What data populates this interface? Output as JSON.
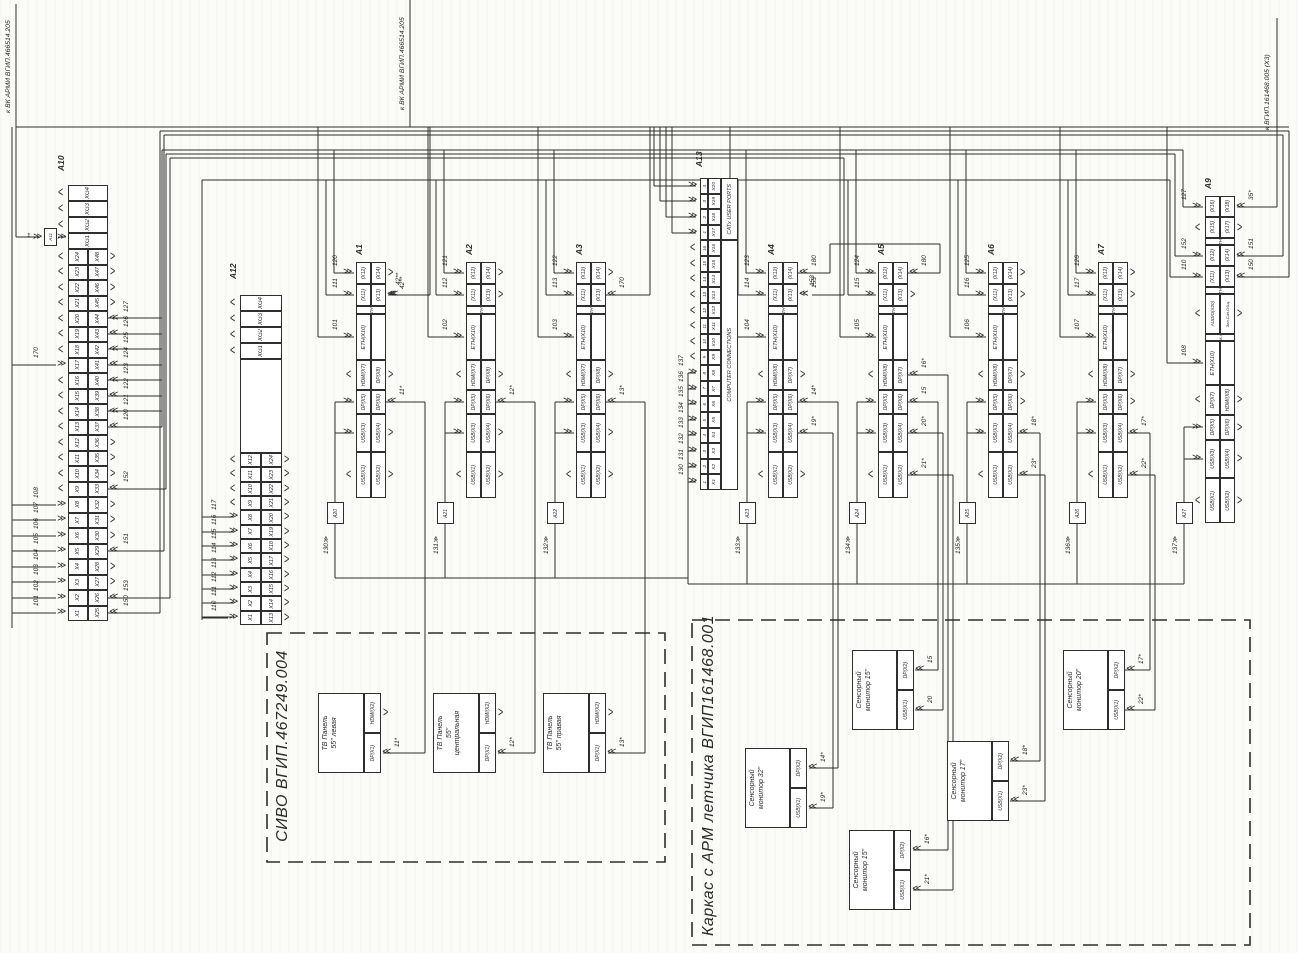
{
  "header_refs": [
    {
      "key": "ref-vk-armi-1",
      "label": "к ВК АРМИ ВГИП.466514.205"
    },
    {
      "key": "ref-vk-armi-2",
      "label": "к ВК АРМИ ВГИП.466514.205"
    },
    {
      "key": "ref-161468-005",
      "label": "к ВГИП.161468.005 (Х3)"
    }
  ],
  "aux_box": {
    "key": "a11",
    "id": "А11",
    "note": "**"
  },
  "panels": [
    {
      "key": "a10",
      "id": "А10",
      "xg": [
        "XG4",
        "XG3",
        "XG2",
        "XG1"
      ],
      "left": [
        "X24",
        "X23",
        "X22",
        "X21",
        "X20",
        "X19",
        "X18",
        "X17",
        "X16",
        "X15",
        "X14",
        "X13",
        "X12",
        "X11",
        "X10",
        "X9",
        "X8",
        "X7",
        "X6",
        "X5",
        "X4",
        "X3",
        "X2",
        "X1"
      ],
      "right": [
        "X48",
        "X47",
        "X46",
        "X45",
        "X44",
        "X43",
        "X42",
        "X41",
        "X40",
        "X39",
        "X38",
        "X37",
        "X36",
        "X35",
        "X34",
        "X33",
        "X32",
        "X31",
        "X30",
        "X29",
        "X28",
        "X27",
        "X26",
        "X25"
      ],
      "wires_left": [
        {
          "row": "X17",
          "label": "170"
        },
        {
          "row": "X8",
          "label": "108"
        },
        {
          "row": "X7",
          "label": "107"
        },
        {
          "row": "X6",
          "label": "106"
        },
        {
          "row": "X5",
          "label": "105"
        },
        {
          "row": "X4",
          "label": "104"
        },
        {
          "row": "X3",
          "label": "103"
        },
        {
          "row": "X2",
          "label": "102"
        },
        {
          "row": "X1",
          "label": "101"
        }
      ],
      "wires_right": [
        {
          "row": "X44",
          "label": "127"
        },
        {
          "row": "X43",
          "label": "126"
        },
        {
          "row": "X42",
          "label": "125"
        },
        {
          "row": "X41",
          "label": "124"
        },
        {
          "row": "X40",
          "label": "123"
        },
        {
          "row": "X39",
          "label": "122"
        },
        {
          "row": "X38",
          "label": "121"
        },
        {
          "row": "X37",
          "label": "120"
        },
        {
          "row": "X33",
          "label": "152"
        },
        {
          "row": "X29",
          "label": "151"
        },
        {
          "row": "X26",
          "label": "153"
        },
        {
          "row": "X25",
          "label": "150"
        }
      ]
    },
    {
      "key": "a12",
      "id": "А12",
      "xg": [
        "XG4",
        "XG3",
        "XG2",
        "XG1"
      ],
      "left": [
        "X12",
        "X11",
        "X10",
        "X9",
        "X8",
        "X7",
        "X6",
        "X5",
        "X4",
        "X3",
        "X2",
        "X1"
      ],
      "right": [
        "X24",
        "X23",
        "X22",
        "X21",
        "X20",
        "X19",
        "X18",
        "X17",
        "X16",
        "X15",
        "X14",
        "X13"
      ],
      "wires_left": [
        {
          "row": "X8",
          "label": "117"
        },
        {
          "row": "X7",
          "label": "116"
        },
        {
          "row": "X6",
          "label": "115"
        },
        {
          "row": "X5",
          "label": "114"
        },
        {
          "row": "X4",
          "label": "113"
        },
        {
          "row": "X3",
          "label": "112"
        },
        {
          "row": "X2",
          "label": "111"
        },
        {
          "row": "X1",
          "label": "110"
        }
      ],
      "wires_right": []
    }
  ],
  "computers": [
    {
      "key": "a1",
      "id": "А1",
      "pairs": [
        [
          "(X12)",
          "(X14)"
        ],
        [
          "(X11)",
          "(X13)"
        ]
      ],
      "eth_note": "ETH**",
      "eth": "ETH(X10)",
      "video": [
        "HDMI(X7)",
        "DP(X8)"
      ],
      "dp": [
        "DP(X5)",
        "DP(X6)"
      ],
      "usb34": [
        "USB(X3)",
        "USB(X4)"
      ],
      "usb12": [
        "USB(X1)",
        "USB(X2)"
      ],
      "wires_left": [
        "120",
        "111",
        "101"
      ],
      "wires_right": {
        "pair1": "",
        "pair2": "42**",
        "video": "",
        "dp": "11*",
        "usb34": "",
        "usb12": ""
      }
    },
    {
      "key": "a2",
      "id": "А2",
      "pairs": [
        [
          "(X12)",
          "(X14)"
        ],
        [
          "(X11)",
          "(X13)"
        ]
      ],
      "eth_note": "ETH**",
      "eth": "ETH(X10)",
      "video": [
        "HDMI(X7)",
        "DP(X8)"
      ],
      "dp": [
        "DP(X5)",
        "DP(X6)"
      ],
      "usb34": [
        "USB(X3)",
        "USB(X4)"
      ],
      "usb12": [
        "USB(X1)",
        "USB(X2)"
      ],
      "wires_left": [
        "121",
        "112",
        "102"
      ],
      "wires_right": {
        "pair1": "",
        "pair2": "",
        "video": "",
        "dp": "12*",
        "usb34": "",
        "usb12": ""
      }
    },
    {
      "key": "a3",
      "id": "А3",
      "pairs": [
        [
          "(X12)",
          "(X14)"
        ],
        [
          "(X11)",
          "(X13)"
        ]
      ],
      "eth_note": "ETH**",
      "eth": "ETH(X10)",
      "video": [
        "HDMI(X7)",
        "DP(X8)"
      ],
      "dp": [
        "DP(X5)",
        "DP(X6)"
      ],
      "usb34": [
        "USB(X3)",
        "USB(X4)"
      ],
      "usb12": [
        "USB(X1)",
        "USB(X2)"
      ],
      "wires_left": [
        "122",
        "113",
        "103"
      ],
      "wires_right": {
        "pair1": "",
        "pair2": "170",
        "video": "",
        "dp": "13*",
        "usb34": "",
        "usb12": ""
      }
    },
    {
      "key": "a4",
      "id": "А4",
      "pairs": [
        [
          "(X12)",
          "(X14)"
        ],
        [
          "(X11)",
          "(X13)"
        ]
      ],
      "eth_note": "ETH**",
      "eth": "ETH(X10)",
      "video": [
        "HDMI(X8)",
        "DP(X7)"
      ],
      "dp": [
        "DP(X5)",
        "DP(X6)"
      ],
      "usb34": [
        "USB(X3)",
        "USB(X4)"
      ],
      "usb12": [
        "USB(X1)",
        "USB(X2)"
      ],
      "wires_left": [
        "123",
        "114",
        "104"
      ],
      "wires_right": {
        "pair1": "180",
        "pair2": "153",
        "video": "",
        "dp": "14*",
        "usb34": "19*",
        "usb12": ""
      }
    },
    {
      "key": "a5",
      "id": "А5",
      "pairs": [
        [
          "(X12)",
          "(X14)"
        ],
        [
          "(X11)",
          "(X13)"
        ]
      ],
      "eth_note": "ETH**",
      "eth": "ETH(X10)",
      "video": [
        "HDMI(X8)",
        "DP(X7)"
      ],
      "dp": [
        "DP(X5)",
        "DP(X6)"
      ],
      "usb34": [
        "USB(X3)",
        "USB(X4)"
      ],
      "usb12": [
        "USB(X1)",
        "USB(X2)"
      ],
      "wires_left": [
        "124",
        "115",
        "105"
      ],
      "wires_right": {
        "pair1": "180",
        "pair2": "",
        "video": "16*",
        "dp": "15",
        "usb34": "20*",
        "usb12": "21*"
      }
    },
    {
      "key": "a6",
      "id": "А6",
      "pairs": [
        [
          "(X12)",
          "(X14)"
        ],
        [
          "(X11)",
          "(X13)"
        ]
      ],
      "eth_note": "ETH**",
      "eth": "ETH(X10)",
      "video": [
        "HDMI(X8)",
        "DP(X7)"
      ],
      "dp": [
        "DP(X5)",
        "DP(X6)"
      ],
      "usb34": [
        "USB(X3)",
        "USB(X4)"
      ],
      "usb12": [
        "USB(X1)",
        "USB(X2)"
      ],
      "wires_left": [
        "125",
        "116",
        "106"
      ],
      "wires_right": {
        "pair1": "",
        "pair2": "",
        "video": "",
        "dp": "",
        "usb34": "18*",
        "usb12": "23*"
      }
    },
    {
      "key": "a7",
      "id": "А7",
      "pairs": [
        [
          "(X12)",
          "(X14)"
        ],
        [
          "(X11)",
          "(X13)"
        ]
      ],
      "eth_note": "ETH**",
      "eth": "ETH(X10)",
      "video": [
        "HDMI(X8)",
        "DP(X7)"
      ],
      "dp": [
        "DP(X5)",
        "DP(X6)"
      ],
      "usb34": [
        "USB(X3)",
        "USB(X4)"
      ],
      "usb12": [
        "USB(X1)",
        "USB(X2)"
      ],
      "wires_left": [
        "126",
        "117",
        "107"
      ],
      "wires_right": {
        "pair1": "",
        "pair2": "",
        "video": "",
        "dp": "",
        "usb34": "17*",
        "usb12": "22*"
      }
    }
  ],
  "a9": {
    "key": "a9",
    "id": "А9",
    "pairs": [
      [
        "(X16)",
        "(X18)"
      ],
      [
        "(X15)",
        "(X17)"
      ],
      [
        "(X12)",
        "(X14)"
      ],
      [
        "(X11)",
        "(X13)"
      ]
    ],
    "eth_note": "ETH**",
    "audio": [
      "AUDIO(X20)",
      "Зел.Син.Общ."
    ],
    "audio_note": "Вых.Ауд",
    "eth": "ETH(X10)",
    "video": [
      "DP(X7)",
      "HDMI(X8)"
    ],
    "dp": [
      "DP(X5)",
      "DP(X6)"
    ],
    "usb34": [
      "USB(X3)",
      "USB(X4)"
    ],
    "usb12": [
      "USB(X1)",
      "USB(X2)"
    ],
    "wires_left": [
      "127",
      "152",
      "110",
      "108"
    ],
    "wires_right": [
      "35*",
      "151",
      "150"
    ]
  },
  "kvm_panel": {
    "key": "a13",
    "id": "А13",
    "rows": [
      {
        "n": "4",
        "x": "X20"
      },
      {
        "n": "3",
        "x": "X19"
      },
      {
        "n": "2",
        "x": "X18"
      },
      {
        "n": "1",
        "x": "X17"
      },
      {
        "n": "16",
        "x": "X16"
      },
      {
        "n": "15",
        "x": "X15"
      },
      {
        "n": "14",
        "x": "X14"
      },
      {
        "n": "13",
        "x": "X13"
      },
      {
        "n": "12",
        "x": "X12"
      },
      {
        "n": "11",
        "x": "X11"
      },
      {
        "n": "10",
        "x": "X10"
      },
      {
        "n": "9",
        "x": "X9"
      },
      {
        "n": "8",
        "x": "X8"
      },
      {
        "n": "7",
        "x": "X7"
      },
      {
        "n": "6",
        "x": "X6"
      },
      {
        "n": "5",
        "x": "X5"
      },
      {
        "n": "4",
        "x": "X4"
      },
      {
        "n": "3",
        "x": "X3"
      },
      {
        "n": "2",
        "x": "X2"
      },
      {
        "n": "1",
        "x": "X1"
      }
    ],
    "captions": [
      {
        "label": "CATx USER PORTS",
        "rows": 4
      },
      {
        "label": "COMPUTER CONNECTIONS",
        "rows": 16
      }
    ],
    "wires": [
      {
        "row": "X8",
        "label": "137"
      },
      {
        "row": "X7",
        "label": "136"
      },
      {
        "row": "X6",
        "label": "135"
      },
      {
        "row": "X5",
        "label": "134"
      },
      {
        "row": "X4",
        "label": "133"
      },
      {
        "row": "X3",
        "label": "132"
      },
      {
        "row": "X2",
        "label": "131"
      },
      {
        "row": "X1",
        "label": "130"
      }
    ]
  },
  "adapters": [
    {
      "key": "a20",
      "id": "А20",
      "wire": "130"
    },
    {
      "key": "a21",
      "id": "А21",
      "wire": "131"
    },
    {
      "key": "a22",
      "id": "А22",
      "wire": "132"
    },
    {
      "key": "a23",
      "id": "А23",
      "wire": "133"
    },
    {
      "key": "a24",
      "id": "А24",
      "wire": "134"
    },
    {
      "key": "a25",
      "id": "А25",
      "wire": "135"
    },
    {
      "key": "a26",
      "id": "А26",
      "wire": "136"
    },
    {
      "key": "a27",
      "id": "А27",
      "wire": "137"
    }
  ],
  "sivo_box": {
    "title": "СИВО ВГИП.467249.004",
    "panels": [
      {
        "key": "tv-left",
        "name_lines": [
          "ТВ Панель",
          "55\" левая"
        ],
        "port_top": "HDMI(X2)",
        "port_bottom": "DP(X1)",
        "wire": "11*"
      },
      {
        "key": "tv-center",
        "name_lines": [
          "ТВ Панель",
          "55\"",
          "центральная"
        ],
        "port_top": "HDMI(X2)",
        "port_bottom": "DP(X1)",
        "wire": "12*"
      },
      {
        "key": "tv-right",
        "name_lines": [
          "ТВ Панель",
          "55\" правая"
        ],
        "port_top": "HDMI(X2)",
        "port_bottom": "DP(X1)",
        "wire": "13*"
      }
    ]
  },
  "cockpit_box": {
    "title": "Каркас с АРМ летчика ВГИП161468.001",
    "monitors": [
      {
        "key": "mon-32",
        "name_lines": [
          "Сенсорный",
          "монитор 32\""
        ],
        "port_top": "DP(X2)",
        "port_bottom": "USB(X1)",
        "wire_top": "14*",
        "wire_bottom": "19*"
      },
      {
        "key": "mon-15a",
        "name_lines": [
          "Сенсорный",
          "монитор 15\""
        ],
        "port_top": "DP(X2)",
        "port_bottom": "USB(X1)",
        "wire_top": "15",
        "wire_bottom": "20"
      },
      {
        "key": "mon-15b",
        "name_lines": [
          "Сенсорный",
          "монитор 15\""
        ],
        "port_top": "DP(X2)",
        "port_bottom": "USB(X1)",
        "wire_top": "16*",
        "wire_bottom": "21*"
      },
      {
        "key": "mon-17",
        "name_lines": [
          "Сенсорный",
          "монитор 17\""
        ],
        "port_top": "DP(X2)",
        "port_bottom": "USB(X1)",
        "wire_top": "18*",
        "wire_bottom": "23*"
      },
      {
        "key": "mon-20",
        "name_lines": [
          "Сенсорный",
          "монитор 20\""
        ],
        "port_top": "DP(X2)",
        "port_bottom": "USB(X1)",
        "wire_top": "17*",
        "wire_bottom": "22*"
      }
    ]
  }
}
